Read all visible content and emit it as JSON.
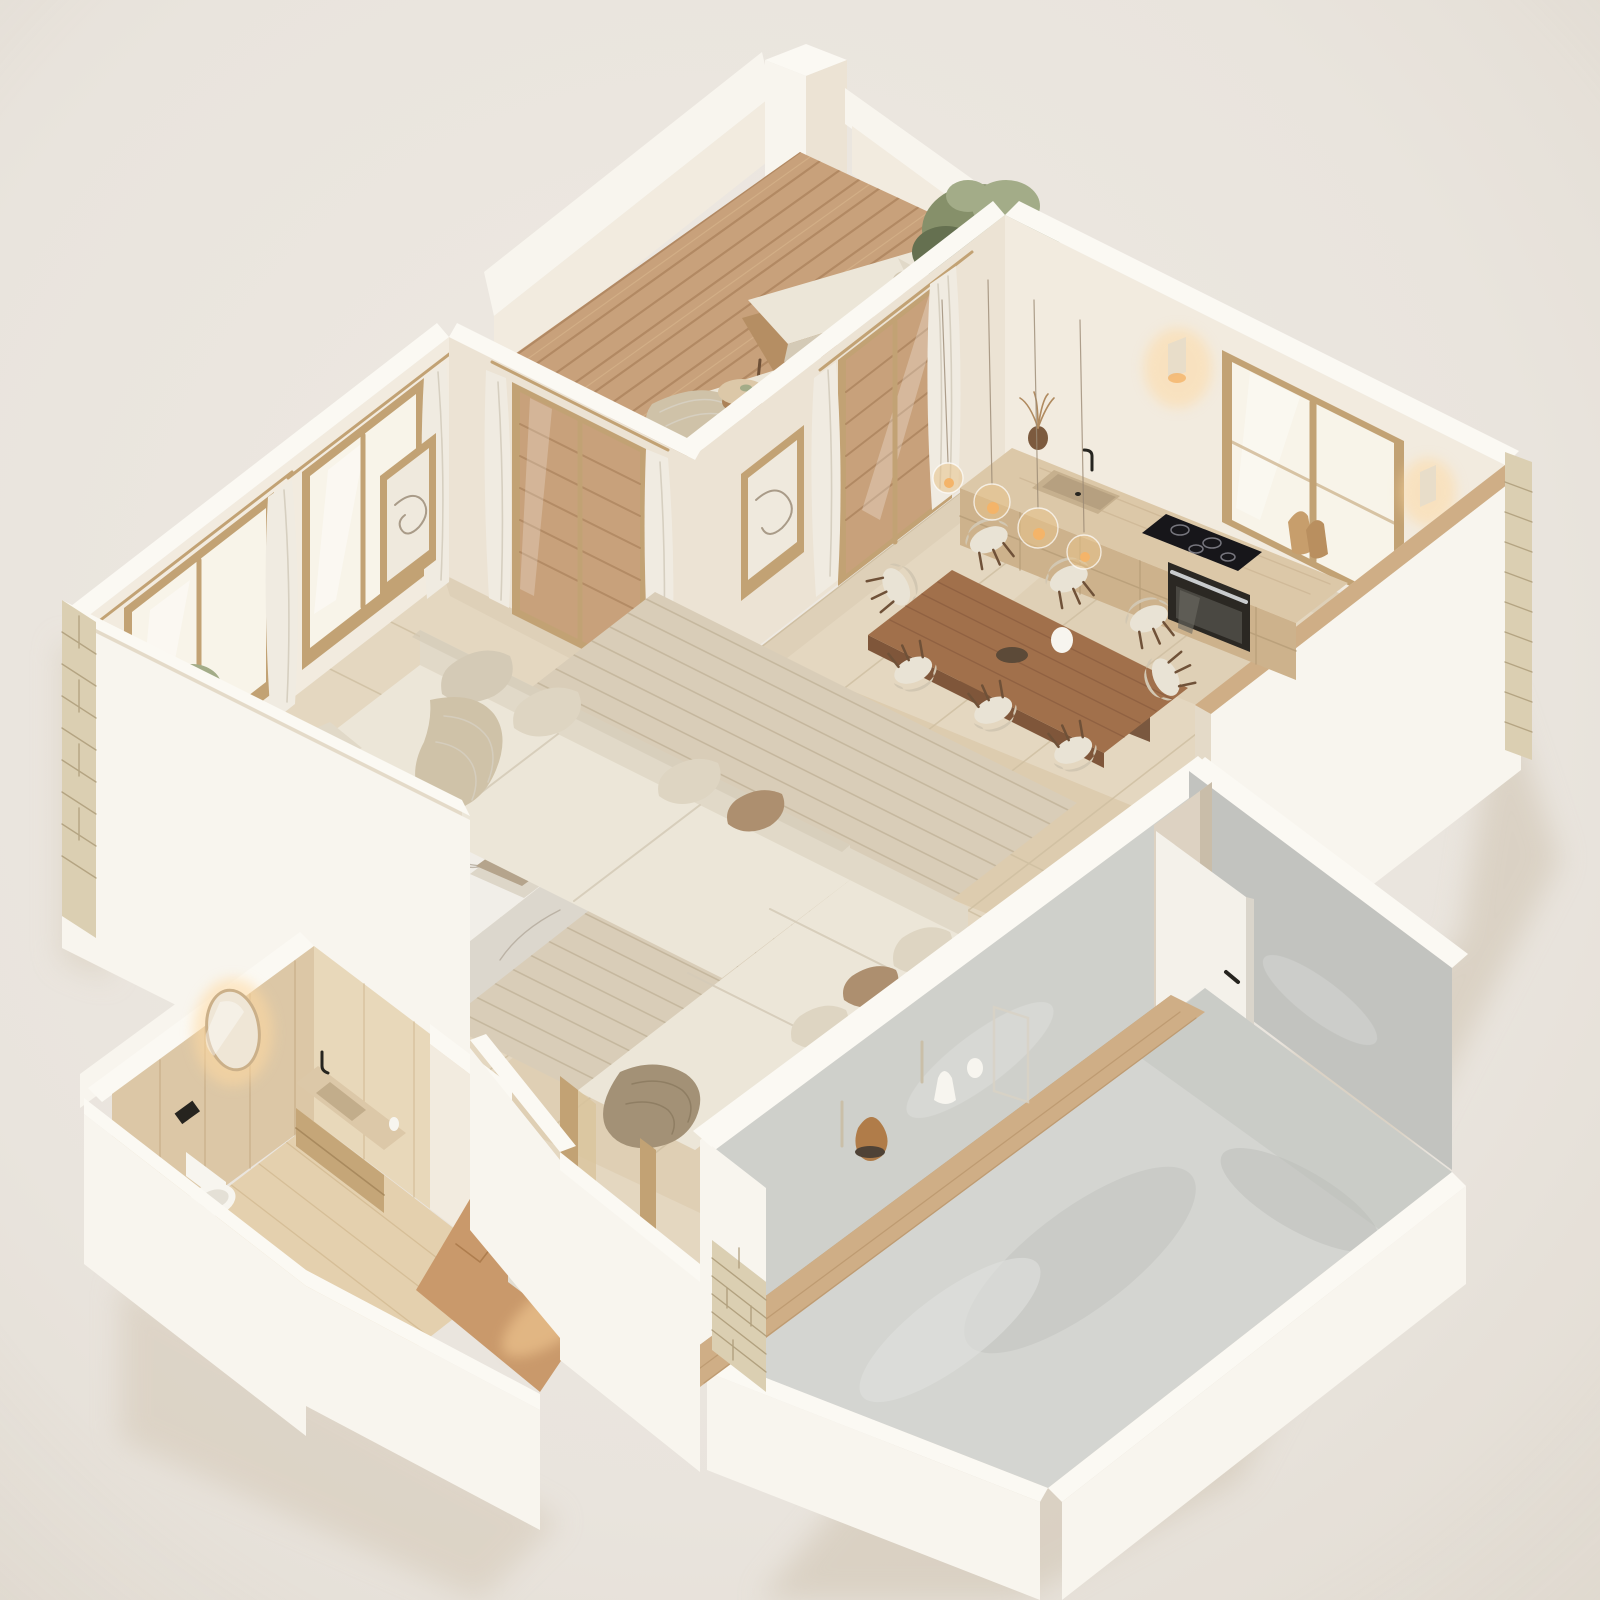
{
  "meta": {
    "type": "isometric-3d-floor-plan-render",
    "description": "Dollhouse cutaway render of a beige minimalist apartment: wooden roof deck with two loungers and chimney, open kitchen with window and counter, dining table with eight chairs and glass pendants, living room with L-shaped cream sectional, marble coffee table and jute rug, wood-clad bathroom with backlit mirror, entry hall with herringbone floor, and one large unfinished concrete room with an open white door."
  },
  "palette": {
    "bg": "#e9e4dd",
    "bgLight": "#efeae3",
    "bgShadow": "#d6cbbb",
    "capWhite": "#fbf9f3",
    "extBright": "#f8f5ee",
    "extShade": "#dbcfbe",
    "intLight": "#f2ebdf",
    "intMid": "#ece3d4",
    "intShade": "#e4dac8",
    "stone": "#dbcfb2",
    "stoneLine": "#ab9a77",
    "deckWood": "#c8a17b",
    "deckLine": "#a37a54",
    "deckHi": "#dcbb92",
    "tile": "#e4d7c0",
    "tileLine": "#cdbd9f",
    "tileWarm": "#d0b890",
    "rug": "#d9cdb8",
    "rugLine": "#c2b49a",
    "sofaSeat": "#ece6d8",
    "sofaBack": "#e1d9c8",
    "sofaShade": "#d4cab6",
    "pillowBrown": "#ad8f6f",
    "throwTan": "#cfc2a8",
    "throwTaupe": "#a39176",
    "marbleTop": "#f1eee8",
    "marbleSide": "#dcd7cd",
    "marbleVein": "#b3aa9c",
    "tableWood": "#a1704b",
    "tableEdge": "#7f563a",
    "chairCream": "#e9e3d5",
    "chairShade": "#d2c7b2",
    "chairLeg": "#6f5138",
    "grayWallLight": "#cfd0cb",
    "grayWallDark": "#c2c3bf",
    "grayFloor": "#d4d5d1",
    "grayFloorDark": "#babbb7",
    "doorWhite": "#f4f1ea",
    "black": "#26241f",
    "glassWarm": "#f8f4e9",
    "frameWood": "#c2a274",
    "curtain": "#f0ebe1",
    "curtainShade": "#d6cfc0",
    "glow": "#ffd9a0",
    "glowCore": "#f4b469",
    "plantGreen": "#86906a",
    "plantDark": "#657050",
    "plantLight": "#a3ac88",
    "ledgeWood": "#cfae86",
    "ledgeFace": "#b08a5e",
    "bathWood": "#dcc7a6",
    "bathWoodLight": "#e8d8ba",
    "bathFloor": "#e4d0ae",
    "herringbone": "#c9996b",
    "herringboneLine": "#a87747",
    "counterTop": "#dcc8a8",
    "counterFace": "#cdb28c",
    "ovenDark": "#2b2823",
    "porcelain": "#f7f5ef",
    "steel": "#c9ccce"
  },
  "scene": {
    "rooms": [
      {
        "name": "roof-deck",
        "objects": [
          "wood-plank-floor",
          "parapet-wall",
          "chimney",
          "lounge-chair",
          "lounge-chair",
          "side-table",
          "olive-tree"
        ]
      },
      {
        "name": "kitchen",
        "objects": [
          "window",
          "wall-sconce",
          "wall-sconce",
          "counter",
          "sink",
          "faucet",
          "induction-cooktop",
          "built-in-oven",
          "cutting-boards",
          "dried-plant-vase",
          "half-wall-wood-cap"
        ]
      },
      {
        "name": "dining-area",
        "objects": [
          "wood-dining-table",
          "dining-chair-x8",
          "glass-pendant-lights",
          "vase",
          "bowl"
        ]
      },
      {
        "name": "living-room",
        "objects": [
          "l-shaped-sofa",
          "marble-coffee-table",
          "jute-rug",
          "pampas-vase",
          "books",
          "olive-tree-pot",
          "wall-sconce",
          "framed-art",
          "framed-art",
          "window",
          "window",
          "curtains",
          "glass-door-to-deck",
          "sliding-door-to-deck"
        ]
      },
      {
        "name": "bathroom",
        "objects": [
          "backlit-oval-mirror",
          "floating-vanity",
          "stone-sink",
          "black-faucet",
          "wall-hung-toilet",
          "flush-plate",
          "wood-paneling"
        ]
      },
      {
        "name": "entry-hall",
        "objects": [
          "herringbone-floor",
          "console-table",
          "white-vase",
          "led-strip",
          "mirror-panel",
          "door-frames",
          "stone-pillar"
        ]
      },
      {
        "name": "unfinished-room",
        "objects": [
          "concrete-floor",
          "concrete-walls",
          "open-white-door",
          "door-handle",
          "wood-display-ledge",
          "decor-vases"
        ]
      }
    ]
  }
}
